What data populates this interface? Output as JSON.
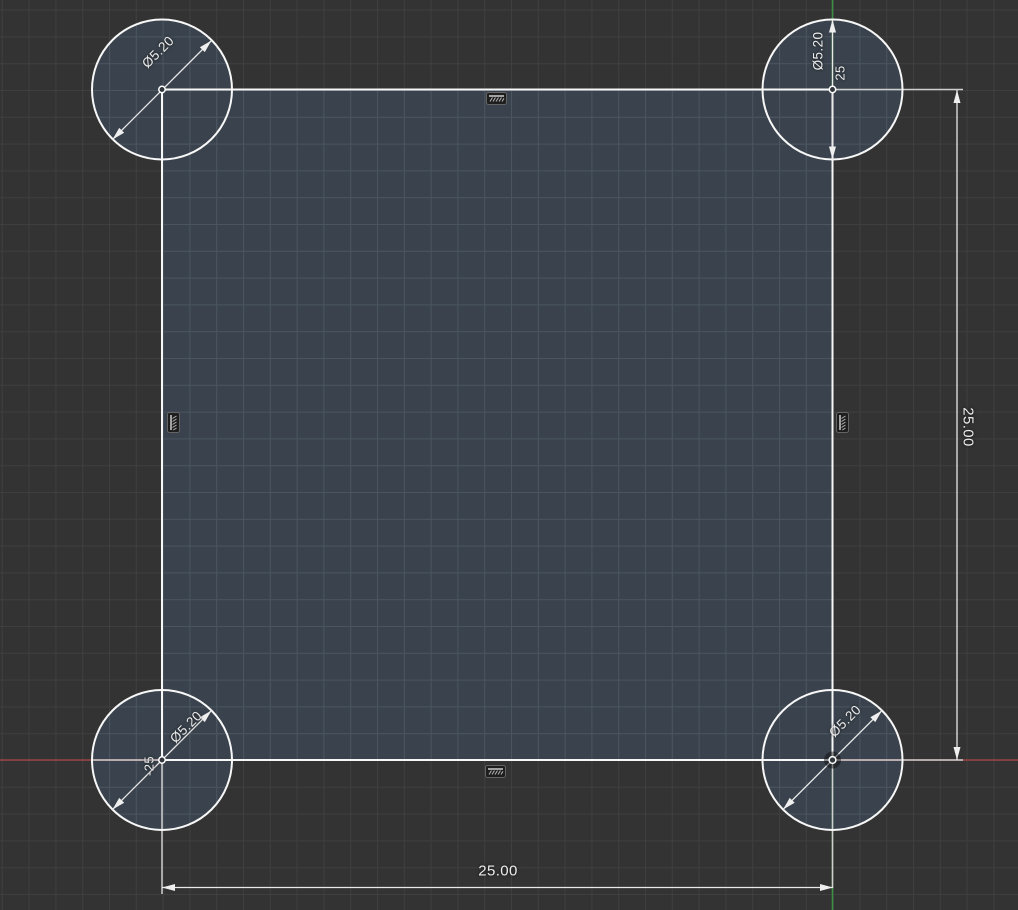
{
  "canvas": {
    "colors": {
      "background": "#333333",
      "grid_outer": "#3f3f3f",
      "profile_fill": "#3a434d",
      "grid_inner": "#4b5560",
      "geometry_white": "#f7f7f7",
      "dimension_gray": "#cfcfcf",
      "x_axis_red": "#9b4444",
      "y_axis_green": "#3e8e45"
    }
  },
  "sketch": {
    "profile": "square with four corner circles",
    "dimensions": {
      "width": {
        "label": "25.00"
      },
      "height": {
        "label": "25.00"
      },
      "corner_y": {
        "label": "25"
      },
      "corner_x": {
        "label": "-25"
      },
      "holes": [
        {
          "corner": "top-left",
          "label": "Ø5.20"
        },
        {
          "corner": "top-right",
          "label": "Ø5.20"
        },
        {
          "corner": "bottom-left",
          "label": "Ø5.20"
        },
        {
          "corner": "bottom-right",
          "label": "Ø5.20"
        }
      ]
    },
    "constraints": {
      "horizontal_top": "horizontal",
      "horizontal_bottom": "horizontal",
      "vertical_left": "vertical",
      "vertical_right": "vertical"
    }
  }
}
